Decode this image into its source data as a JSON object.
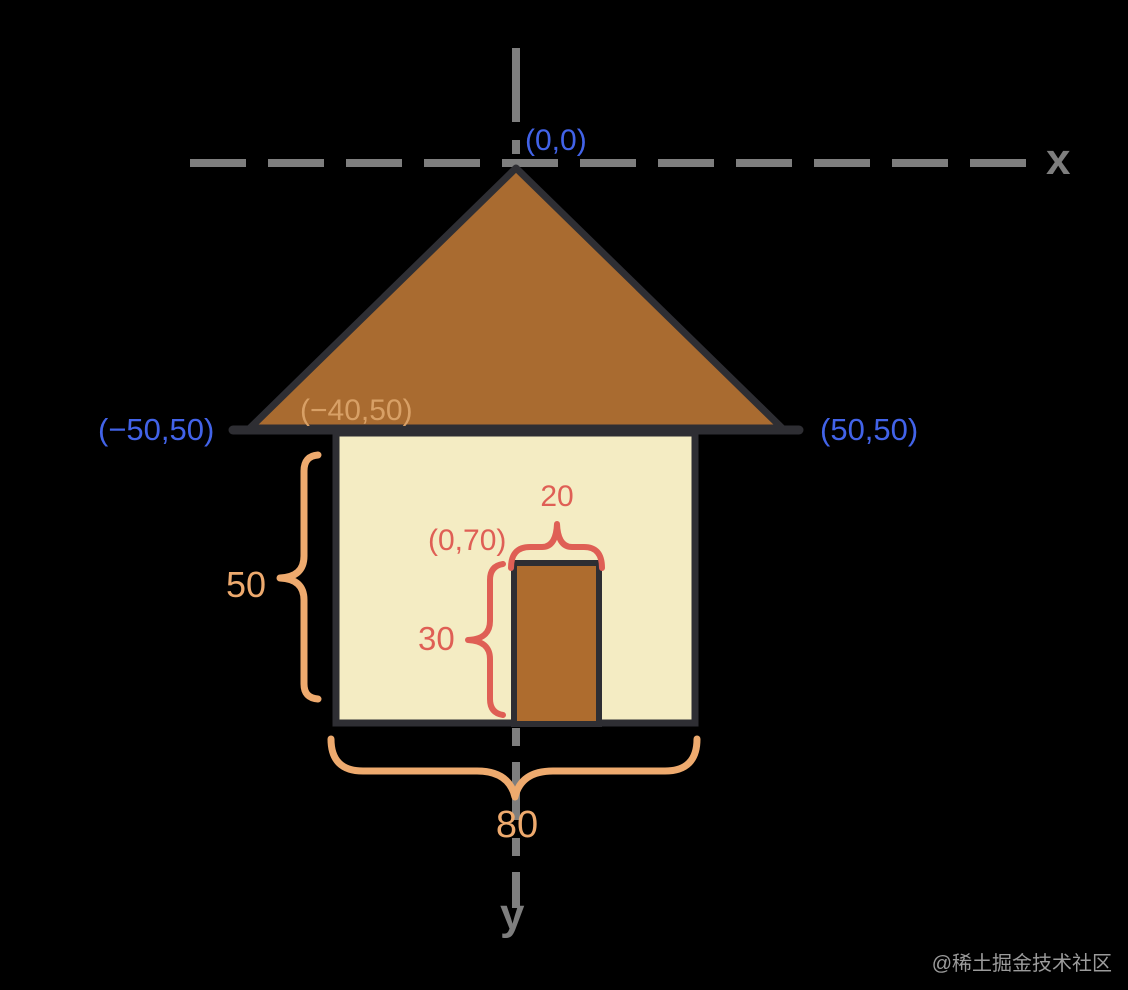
{
  "colors": {
    "background": "#000000",
    "axis_gray": "#7e7e7e",
    "outline_dark": "#2e2e33",
    "roof_brown": "#a96b30",
    "door_brown": "#ae6c2e",
    "wall_cream": "#f4ecc3",
    "coordinate_blue": "#4263e8",
    "roof_corner_tan": "#d8a066",
    "door_dimension_red": "#df5f55",
    "wall_dimension_orange": "#eeaa6e",
    "watermark_gray": "#9b9b9b"
  },
  "axes": {
    "x_label": "x",
    "y_label": "y"
  },
  "point_labels": {
    "origin": "(0,0)",
    "roof_base_left": "(−50,50)",
    "roof_base_right": "(50,50)",
    "wall_top_left": "(−40,50)",
    "door_top_left": "(0,70)"
  },
  "dimension_labels": {
    "door_width": "20",
    "door_height": "30",
    "wall_height": "50",
    "wall_width": "80"
  },
  "watermark": "@稀土掘金技术社区"
}
